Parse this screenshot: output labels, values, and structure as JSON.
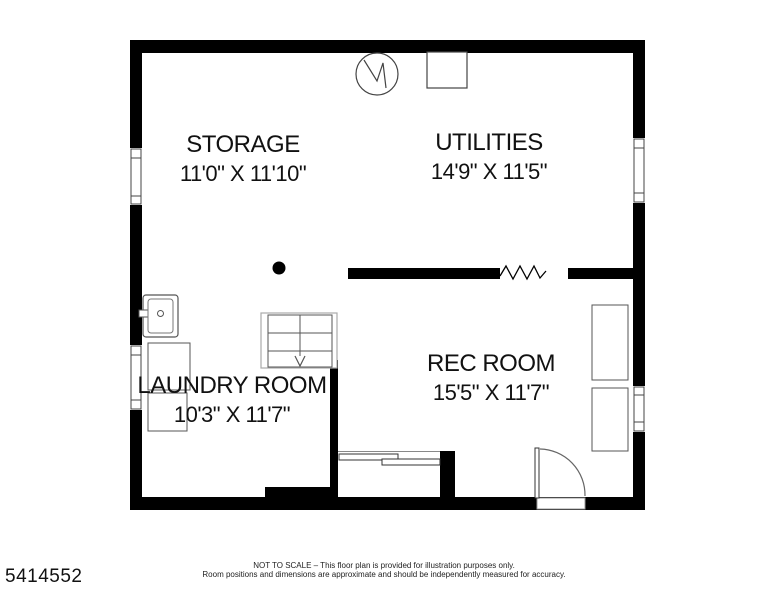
{
  "plan": {
    "id_number": "5414552",
    "rooms": [
      {
        "name": "STORAGE",
        "dimensions": "11'0\" X 11'10\""
      },
      {
        "name": "UTILITIES",
        "dimensions": "14'9\" X 11'5\""
      },
      {
        "name": "LAUNDRY ROOM",
        "dimensions": "10'3\" X 11'7\""
      },
      {
        "name": "REC ROOM",
        "dimensions": "15'5\" X 11'7\""
      }
    ],
    "footer": {
      "line1": "NOT TO SCALE – This floor plan is provided for illustration purposes only.",
      "line2": "Room positions and dimensions are approximate and should be independently measured for accuracy."
    },
    "colors": {
      "wall": "#000000",
      "background": "#ffffff",
      "symbol_stroke": "#555555"
    }
  }
}
